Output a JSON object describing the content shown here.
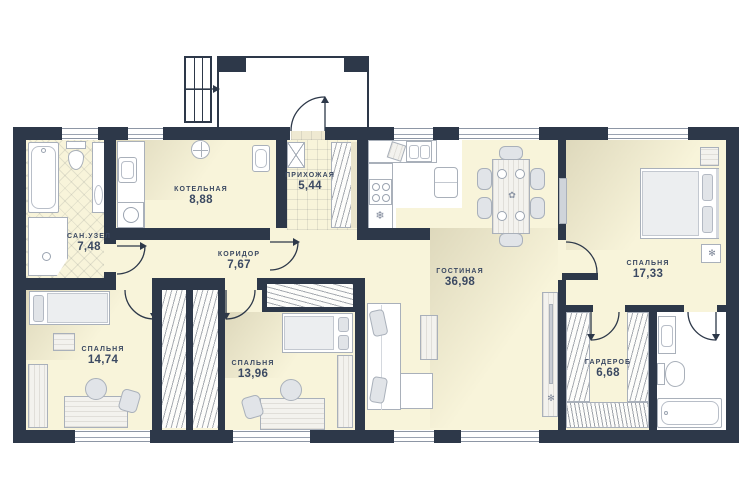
{
  "plan": {
    "rooms": [
      {
        "id": "sanuzel",
        "name": "САН.УЗЕЛ",
        "area": "7,48"
      },
      {
        "id": "kotelnaya",
        "name": "КОТЕЛЬНАЯ",
        "area": "8,88"
      },
      {
        "id": "prihozhaya",
        "name": "ПРИХОЖАЯ",
        "area": "5,44"
      },
      {
        "id": "koridor",
        "name": "КОРИДОР",
        "area": "7,67"
      },
      {
        "id": "gostinaya",
        "name": "ГОСТИНАЯ",
        "area": "36,98"
      },
      {
        "id": "spalnya-1",
        "name": "СПАЛЬНЯ",
        "area": "17,33"
      },
      {
        "id": "spalnya-2",
        "name": "СПАЛЬНЯ",
        "area": "14,74"
      },
      {
        "id": "spalnya-3",
        "name": "СПАЛЬНЯ",
        "area": "13,96"
      },
      {
        "id": "garderob",
        "name": "ГАРДЕРОБ",
        "area": "6,68"
      }
    ],
    "icons": {
      "freezer": "❄",
      "plant": "✻",
      "flower": "✿"
    },
    "colors": {
      "wall": "#2d3849",
      "floor": "#f8f4da",
      "label": "#3b4962"
    }
  }
}
